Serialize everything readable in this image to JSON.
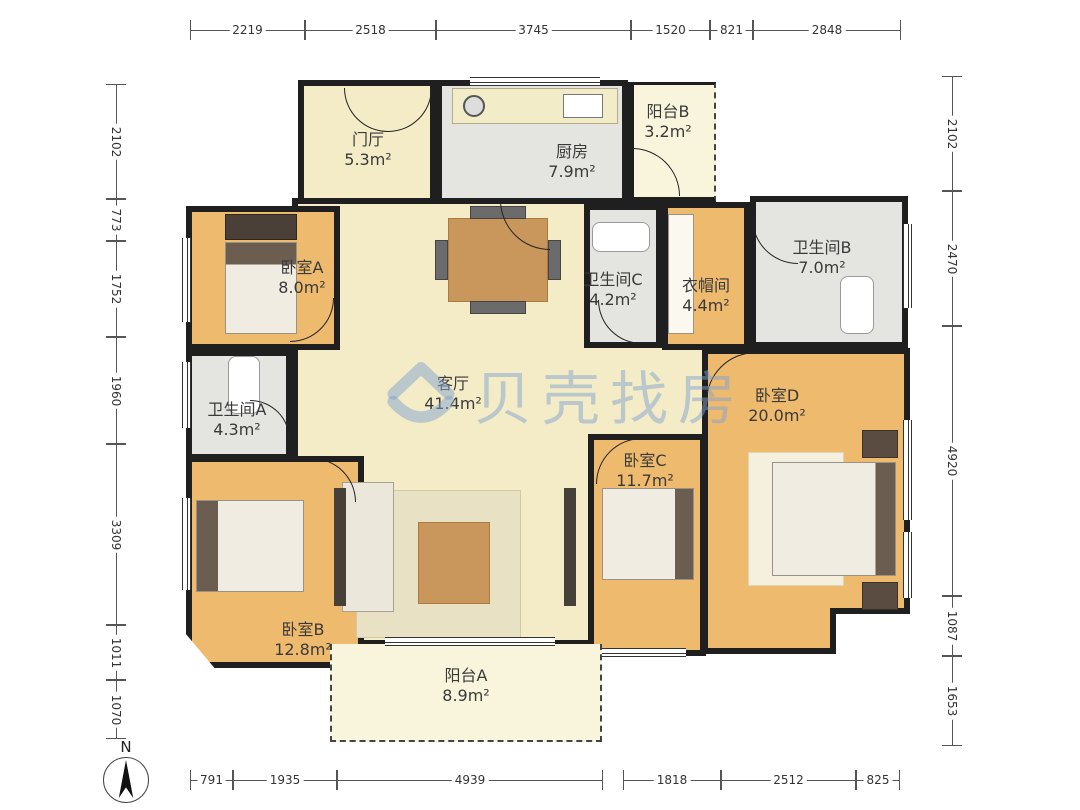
{
  "plan": {
    "watermark": "贝壳找房",
    "compass_label": "N"
  },
  "rooms": {
    "entry": {
      "name": "门厅",
      "area": "5.3m²"
    },
    "kitchen": {
      "name": "厨房",
      "area": "7.9m²"
    },
    "balcony_b": {
      "name": "阳台B",
      "area": "3.2m²"
    },
    "bedroom_a": {
      "name": "卧室A",
      "area": "8.0m²"
    },
    "bath_a": {
      "name": "卫生间A",
      "area": "4.3m²"
    },
    "bath_c": {
      "name": "卫生间C",
      "area": "4.2m²"
    },
    "closet": {
      "name": "衣帽间",
      "area": "4.4m²"
    },
    "bath_b": {
      "name": "卫生间B",
      "area": "7.0m²"
    },
    "living": {
      "name": "客厅",
      "area": "41.4m²"
    },
    "bedroom_d": {
      "name": "卧室D",
      "area": "20.0m²"
    },
    "bedroom_c": {
      "name": "卧室C",
      "area": "11.7m²"
    },
    "bedroom_b": {
      "name": "卧室B",
      "area": "12.8m²"
    },
    "balcony_a": {
      "name": "阳台A",
      "area": "8.9m²"
    }
  },
  "dims": {
    "top": [
      "2219",
      "2518",
      "3745",
      "1520",
      "821",
      "2848"
    ],
    "bottom": [
      "791",
      "1935",
      "4939",
      "1818",
      "2512",
      "825"
    ],
    "left": [
      "2102",
      "773",
      "1752",
      "1960",
      "3309",
      "1011",
      "1070"
    ],
    "right": [
      "2102",
      "2470",
      "4920",
      "1087",
      "1653"
    ]
  },
  "colors": {
    "wall": "#1f1f1f",
    "bedroom_wood": "#eeba6e",
    "living_cream": "#f4ecc6",
    "tile_gray": "#e4e4e0",
    "balcony_pale": "#f9f5dc",
    "watermark_blue": "#80a2d0"
  }
}
